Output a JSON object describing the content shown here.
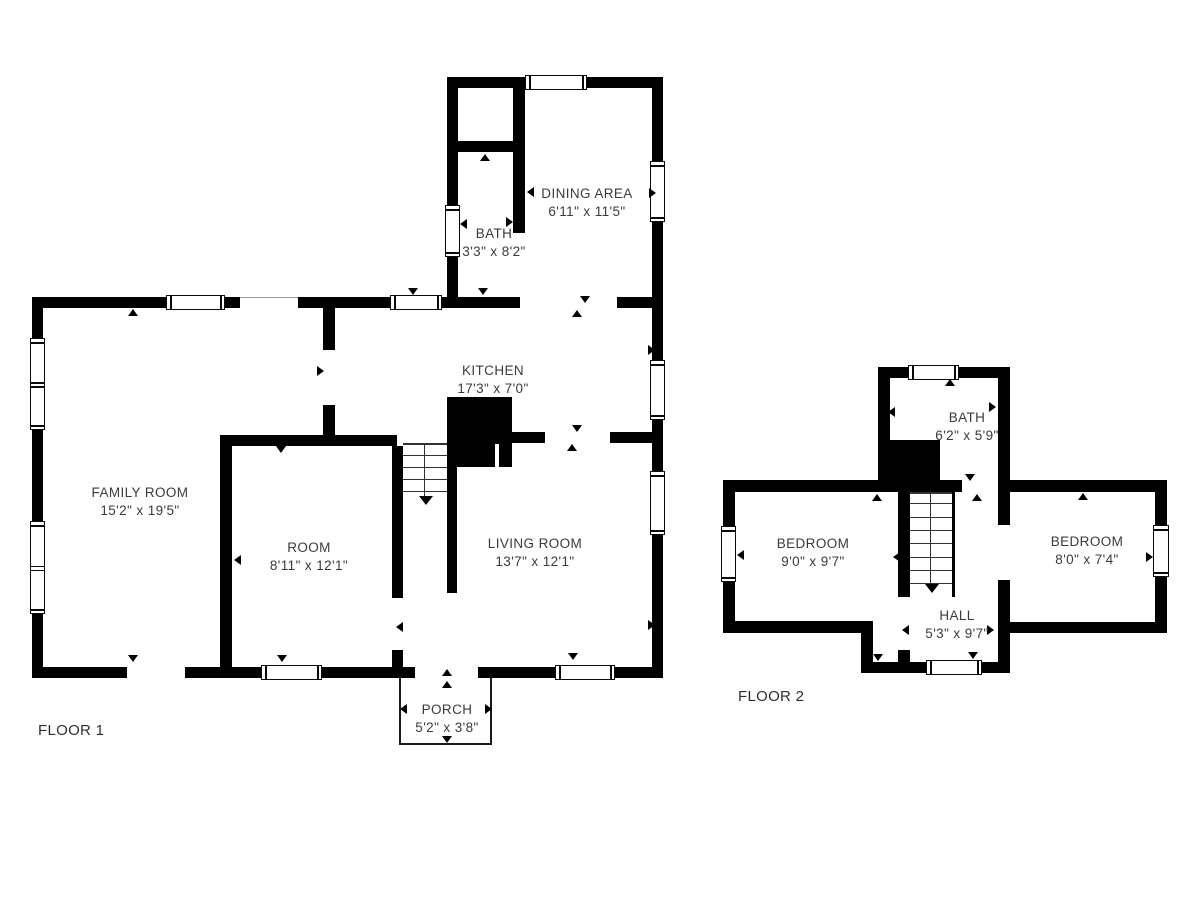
{
  "colors": {
    "wall": "#000000",
    "label_text": "#3b3b3b",
    "background": "#ffffff"
  },
  "floor1": {
    "title": "FLOOR 1",
    "rooms": {
      "family_room": {
        "name": "FAMILY ROOM",
        "dims": "15'2\" x 19'5\""
      },
      "room": {
        "name": "ROOM",
        "dims": "8'11\" x 12'1\""
      },
      "living_room": {
        "name": "LIVING ROOM",
        "dims": "13'7\" x 12'1\""
      },
      "kitchen": {
        "name": "KITCHEN",
        "dims": "17'3\" x 7'0\""
      },
      "dining_area": {
        "name": "DINING AREA",
        "dims": "6'11\" x 11'5\""
      },
      "bath": {
        "name": "BATH",
        "dims": "3'3\" x 8'2\""
      },
      "porch": {
        "name": "PORCH",
        "dims": "5'2\" x 3'8\""
      }
    }
  },
  "floor2": {
    "title": "FLOOR 2",
    "rooms": {
      "bath": {
        "name": "BATH",
        "dims": "6'2\" x 5'9\""
      },
      "bedroom_left": {
        "name": "BEDROOM",
        "dims": "9'0\" x 9'7\""
      },
      "bedroom_right": {
        "name": "BEDROOM",
        "dims": "8'0\" x 7'4\""
      },
      "hall": {
        "name": "HALL",
        "dims": "5'3\" x 9'7\""
      }
    }
  }
}
